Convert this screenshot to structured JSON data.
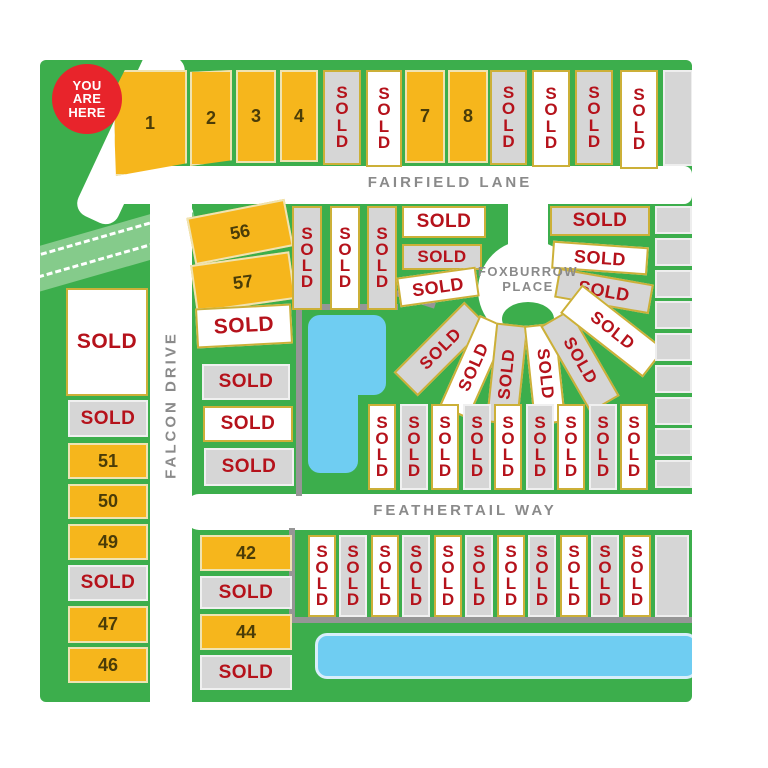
{
  "you_are_here": {
    "line1": "YOU",
    "line2": "ARE",
    "line3": "HERE"
  },
  "streets": {
    "fairfield_lane": "FAIRFIELD LANE",
    "falcon_drive": "FALCON DRIVE",
    "foxburrow_line1": "FOXBURROW",
    "foxburrow_line2": "PLACE",
    "feathertail_way": "FEATHERTAIL WAY"
  },
  "lots": {
    "top_row": [
      {
        "label": "1"
      },
      {
        "label": "2"
      },
      {
        "label": "3"
      },
      {
        "label": "4"
      },
      {
        "label": "SOLD"
      },
      {
        "label": "SOLD"
      },
      {
        "label": "7"
      },
      {
        "label": "8"
      },
      {
        "label": "SOLD"
      },
      {
        "label": "SOLD"
      },
      {
        "label": "SOLD"
      },
      {
        "label": "SOLD"
      }
    ],
    "block_56_57": [
      {
        "label": "56"
      },
      {
        "label": "57"
      }
    ],
    "mid_columns": [
      {
        "label": "SOLD"
      },
      {
        "label": "SOLD"
      },
      {
        "label": "SOLD"
      }
    ],
    "culdesac_left": [
      {
        "label": "SOLD"
      },
      {
        "label": "SOLD"
      },
      {
        "label": "SOLD"
      }
    ],
    "culdesac_right": [
      {
        "label": "SOLD"
      },
      {
        "label": "SOLD"
      },
      {
        "label": "SOLD"
      }
    ],
    "culdesac_fan": [
      {
        "label": "SOLD"
      },
      {
        "label": "SOLD"
      },
      {
        "label": "SOLD"
      },
      {
        "label": "SOLD"
      },
      {
        "label": "SOLD"
      },
      {
        "label": "SOLD"
      }
    ],
    "mid_stack": [
      {
        "label": "SOLD"
      },
      {
        "label": "SOLD"
      },
      {
        "label": "SOLD"
      },
      {
        "label": "SOLD"
      }
    ],
    "west_column": [
      {
        "label": "SOLD"
      },
      {
        "label": "SOLD"
      },
      {
        "label": "51"
      },
      {
        "label": "50"
      },
      {
        "label": "49"
      },
      {
        "label": "SOLD"
      },
      {
        "label": "47"
      },
      {
        "label": "46"
      }
    ],
    "feathertail_north": [
      {
        "label": "SOLD"
      },
      {
        "label": "SOLD"
      },
      {
        "label": "SOLD"
      },
      {
        "label": "SOLD"
      },
      {
        "label": "SOLD"
      },
      {
        "label": "SOLD"
      },
      {
        "label": "SOLD"
      },
      {
        "label": "SOLD"
      },
      {
        "label": "SOLD"
      }
    ],
    "south_column": [
      {
        "label": "42"
      },
      {
        "label": "SOLD"
      },
      {
        "label": "44"
      },
      {
        "label": "SOLD"
      }
    ],
    "feathertail_south": [
      {
        "label": "SOLD"
      },
      {
        "label": "SOLD"
      },
      {
        "label": "SOLD"
      },
      {
        "label": "SOLD"
      },
      {
        "label": "SOLD"
      },
      {
        "label": "SOLD"
      },
      {
        "label": "SOLD"
      },
      {
        "label": "SOLD"
      },
      {
        "label": "SOLD"
      },
      {
        "label": "SOLD"
      },
      {
        "label": "SOLD"
      }
    ]
  },
  "colors": {
    "map_green": "#3cae4c",
    "light_green_band": "#85cb8b",
    "street_white": "#ffffff",
    "street_label_gray": "#8a8a8a",
    "yellow_lot": "#f6b61c",
    "gray_lot": "#d6d6d6",
    "white_lot": "#ffffff",
    "sold_text_red": "#b5121b",
    "pond_blue": "#6fcdf2",
    "badge_red": "#e8242b"
  }
}
